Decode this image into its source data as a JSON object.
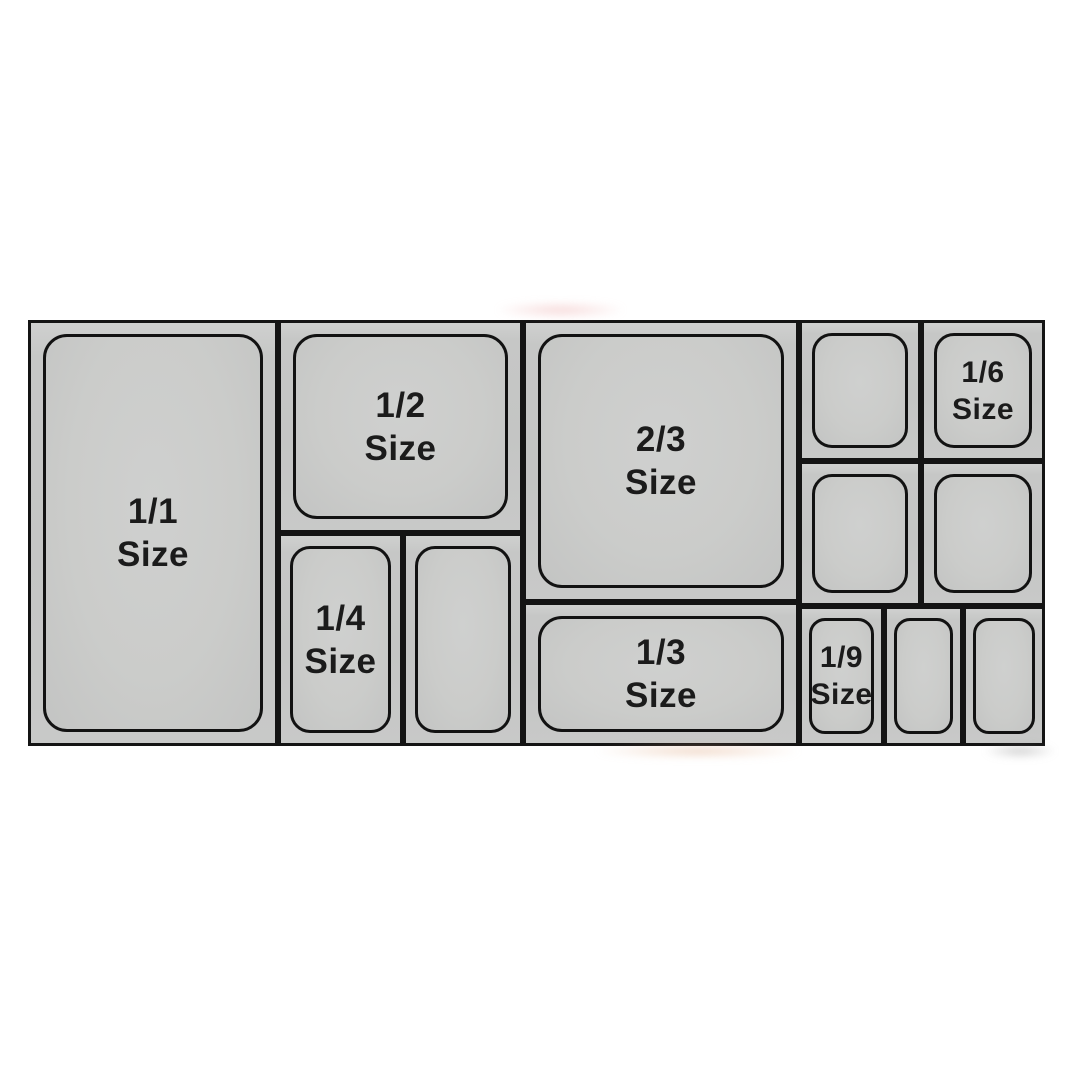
{
  "page": {
    "background_color": "#ffffff",
    "description_label": "Gastronorm pan size chart"
  },
  "diagram": {
    "type": "gastronorm-pan-size-chart",
    "border_color": "#141414",
    "cell_fill_color": "#c6c7c6",
    "pan_fill_color": "#cbccca",
    "label_color": "#1b1b1b",
    "pans": [
      {
        "name": "pan-1-1",
        "fraction": "1/1",
        "word": "Size"
      },
      {
        "name": "pan-1-2",
        "fraction": "1/2",
        "word": "Size"
      },
      {
        "name": "pan-1-4",
        "fraction": "1/4",
        "word": "Size"
      },
      {
        "name": "pan-1-4-unlabeled",
        "fraction": "",
        "word": ""
      },
      {
        "name": "pan-2-3",
        "fraction": "2/3",
        "word": "Size"
      },
      {
        "name": "pan-1-3",
        "fraction": "1/3",
        "word": "Size"
      },
      {
        "name": "pan-1-6-unlabeled",
        "fraction": "",
        "word": ""
      },
      {
        "name": "pan-1-6",
        "fraction": "1/6",
        "word": "Size"
      },
      {
        "name": "pan-1-6-unlabeled-2",
        "fraction": "",
        "word": ""
      },
      {
        "name": "pan-1-6-unlabeled-3",
        "fraction": "",
        "word": ""
      },
      {
        "name": "pan-1-9",
        "fraction": "1/9",
        "word": "Size"
      },
      {
        "name": "pan-1-9-unlabeled",
        "fraction": "",
        "word": ""
      },
      {
        "name": "pan-1-9-unlabeled-2",
        "fraction": "",
        "word": ""
      }
    ]
  }
}
